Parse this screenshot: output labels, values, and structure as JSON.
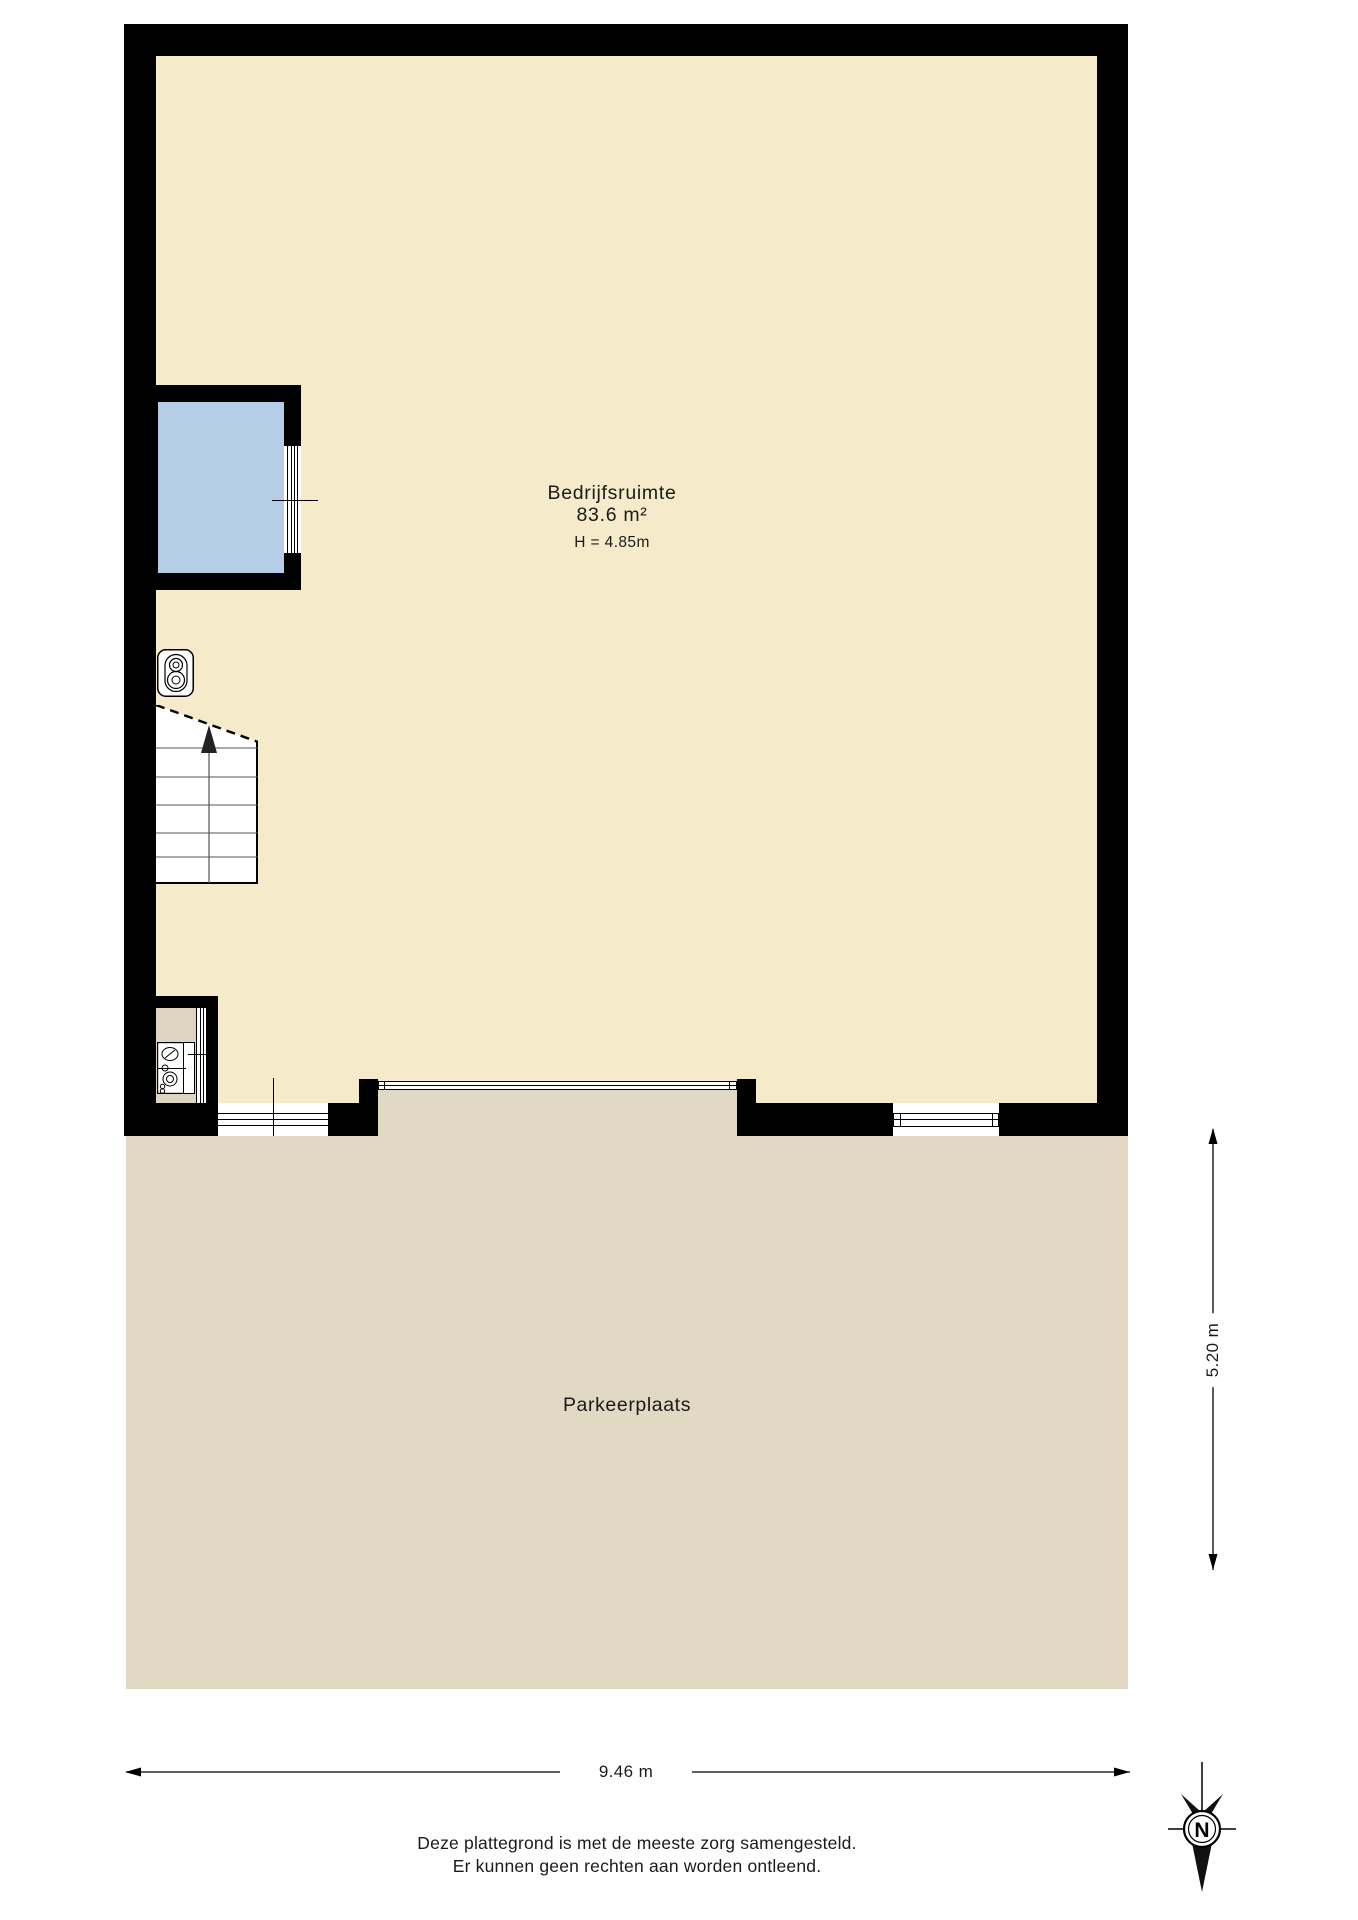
{
  "plan": {
    "room": {
      "name": "Bedrijfsruimte",
      "area": "83.6 m²",
      "ceiling_height": "H = 4.85m"
    },
    "outdoor_area": {
      "name": "Parkeerplaats"
    },
    "dimensions": {
      "width_label": "9.46 m",
      "depth_label": "5.20 m"
    },
    "compass": {
      "north_label": "N"
    },
    "footer": {
      "line1": "Deze plattegrond is met de meeste zorg samengesteld.",
      "line2": "Er kunnen geen rechten aan worden ontleend."
    },
    "colors": {
      "wall": "#000000",
      "room_floor": "#f5eac9",
      "outdoor_floor": "#e1d9c4",
      "closet_floor": "#ddd5c1",
      "blue_room": "#b6cde7",
      "page_background": "#ffffff"
    }
  }
}
